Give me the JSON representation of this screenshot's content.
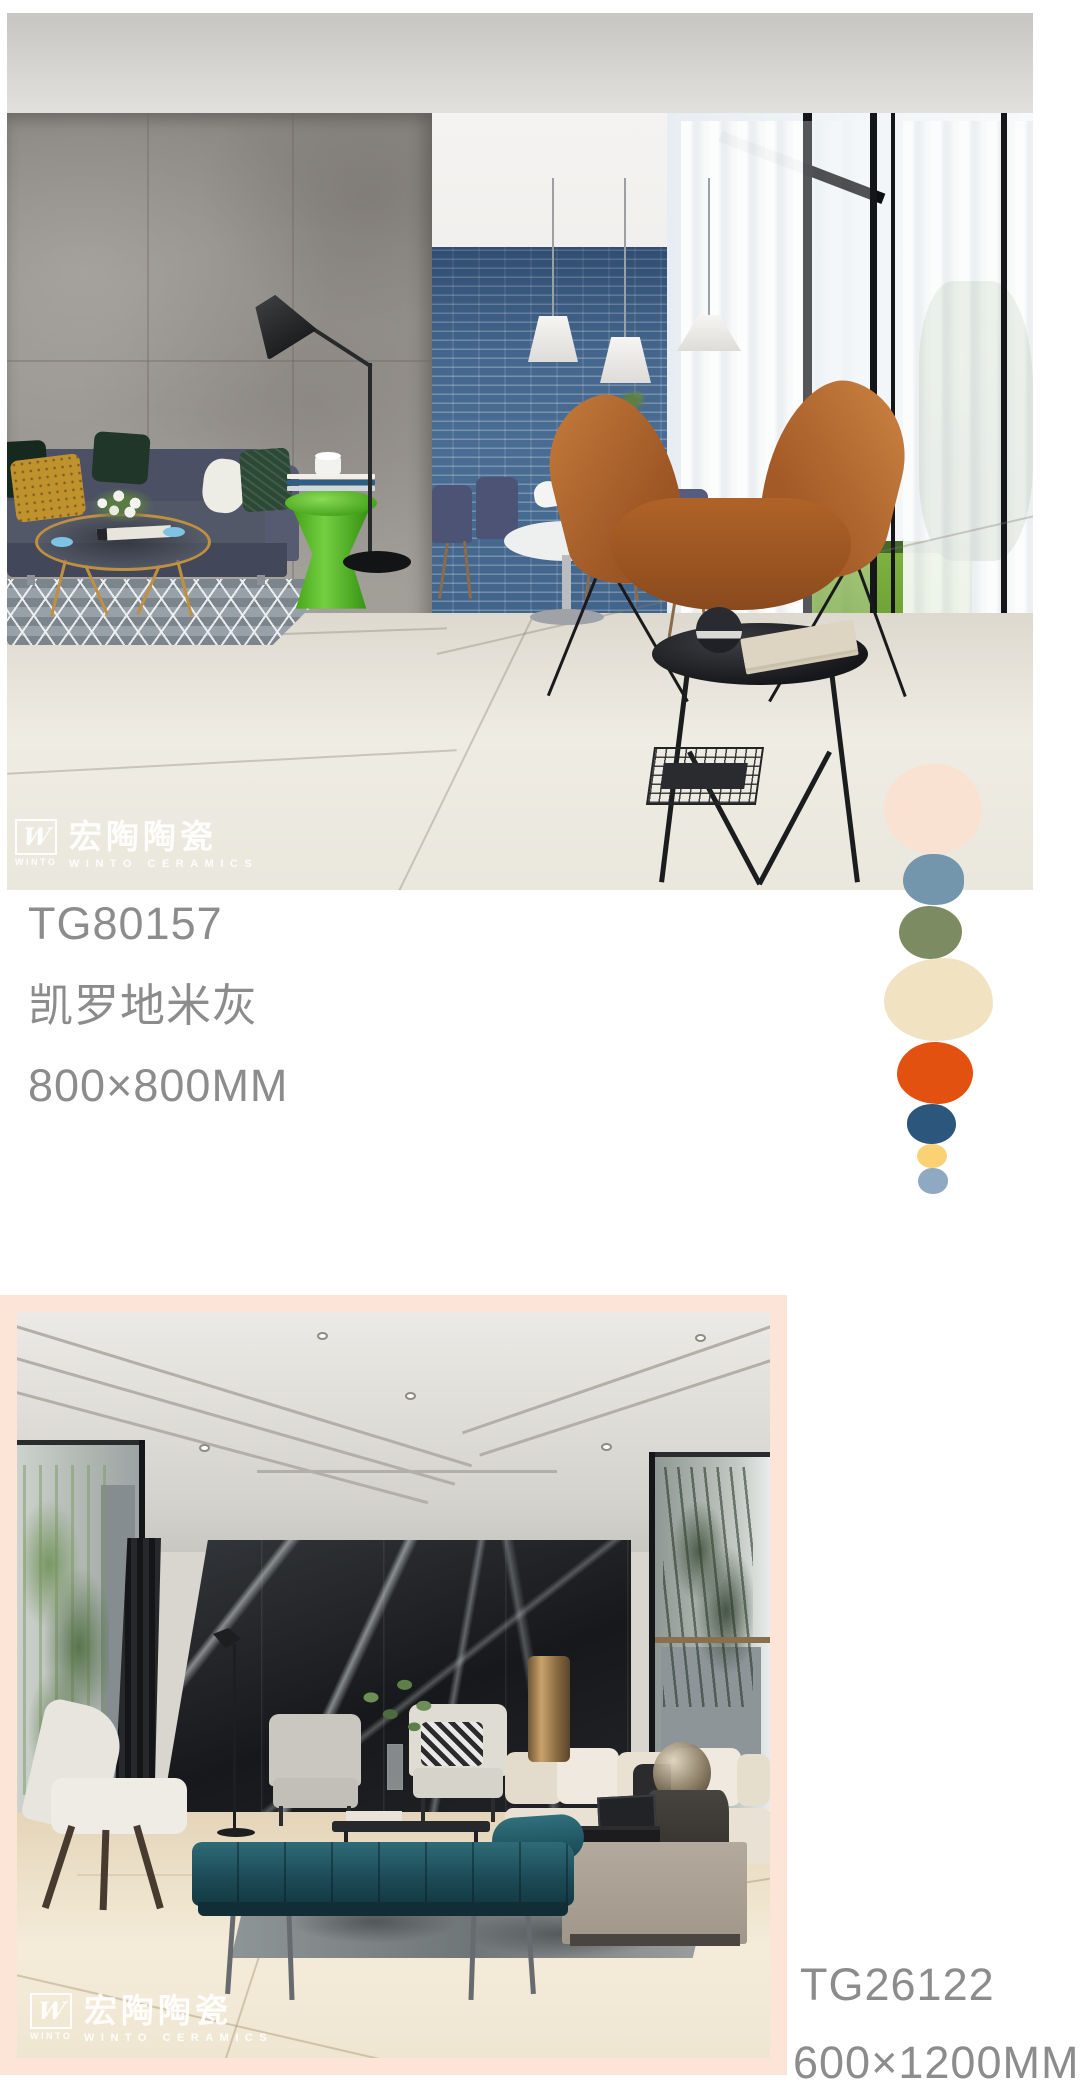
{
  "brand": {
    "logo_mark": "W",
    "logo_sub": "WINTO",
    "name_zh": "宏陶陶瓷",
    "name_en": "WINTO CERAMICS"
  },
  "products": [
    {
      "code": "TG80157",
      "name": "凯罗地米灰",
      "size": "800×800MM"
    },
    {
      "code": "TG26122",
      "size": "600×1200MM"
    }
  ],
  "palette_dots": [
    {
      "name": "peach",
      "color": "#f9e2d1"
    },
    {
      "name": "steel-blue",
      "color": "#7496ad"
    },
    {
      "name": "olive-green",
      "color": "#7c8b62"
    },
    {
      "name": "cream",
      "color": "#f1e2c1"
    },
    {
      "name": "orange",
      "color": "#e25110"
    },
    {
      "name": "navy",
      "color": "#2c567c"
    },
    {
      "name": "yellow",
      "color": "#fad173"
    },
    {
      "name": "light-blue",
      "color": "#8fa9c3"
    }
  ],
  "colors": {
    "text": "#8c8c8c",
    "frame_pink": "#fce4d7",
    "page_background": "#ffffff"
  }
}
